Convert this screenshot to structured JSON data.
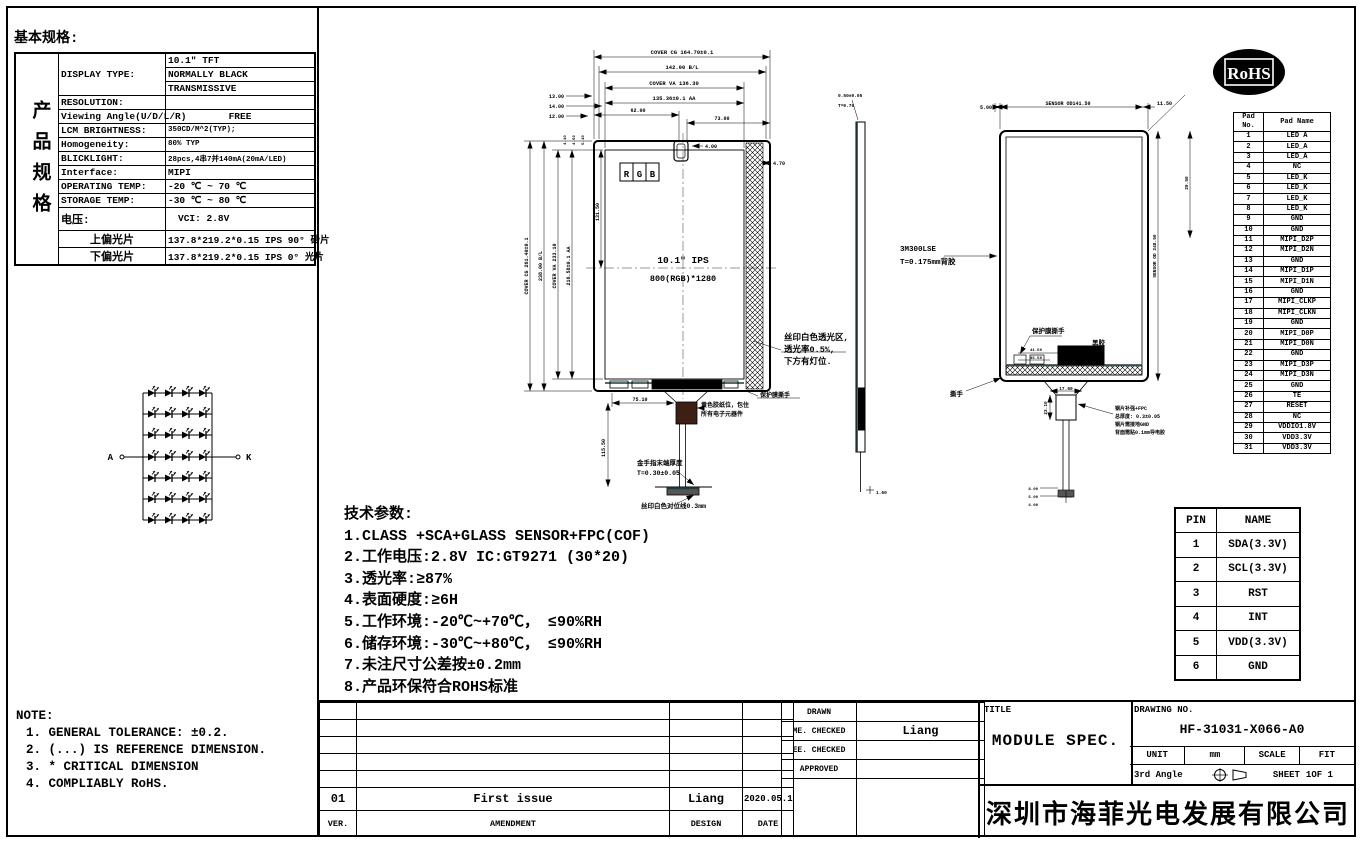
{
  "spec": {
    "heading": "基本规格:",
    "side": "产品规格",
    "rows": [
      {
        "label": "DISPLAY TYPE:",
        "value": "10.1\" TFT"
      },
      {
        "label": "",
        "value": "NORMALLY BLACK"
      },
      {
        "label": "",
        "value": "TRANSMISSIVE"
      },
      {
        "label": "RESOLUTION:",
        "value": ""
      },
      {
        "label": "Viewing Angle(U/D/L/R)",
        "value": "FREE"
      },
      {
        "label": "LCM BRIGHTNESS:",
        "value": "350CD/M^2(TYP);"
      },
      {
        "label": "Homogeneity:",
        "value": "80% TYP"
      },
      {
        "label": "BLICKLIGHT:",
        "value": "28pcs,4串7并140mA(20mA/LED)"
      },
      {
        "label": "Interface:",
        "value": "MIPI"
      },
      {
        "label": "OPERATING TEMP:",
        "value": "-20 ℃ ~ 70 ℃"
      },
      {
        "label": "STORAGE TEMP:",
        "value": "-30 ℃ ~ 80 ℃"
      },
      {
        "label": "电压:",
        "value": "VCI: 2.8V"
      },
      {
        "label": "上偏光片",
        "value": "137.8*219.2*0.15 IPS 90° 砂片"
      },
      {
        "label": "下偏光片",
        "value": "137.8*219.2*0.15 IPS 0° 光片"
      }
    ]
  },
  "led_diagram": {
    "anode_label": "A",
    "cathode_label": "K"
  },
  "tech": {
    "title": "技术参数:",
    "items": [
      "1.CLASS +SCA+GLASS SENSOR+FPC(COF)",
      "2.工作电压:2.8V  IC:GT9271 (30*20)",
      "3.透光率:≥87%",
      "4.表面硬度:≥6H",
      "5.工作环境:-20℃~+70℃， ≤90%RH",
      "6.储存环境:-30℃~+80℃， ≤90%RH",
      "7.未注尺寸公差按±0.2mm",
      "8.产品环保符合ROHS标准"
    ]
  },
  "note": {
    "title": "NOTE:",
    "items": [
      "1. GENERAL TOLERANCE: ±0.2.",
      "2. (...) IS REFERENCE DIMENSION.",
      "3. * CRITICAL DIMENSION",
      "4. COMPLIABLY RoHS."
    ]
  },
  "pad_table": {
    "headers": [
      "Pad No.",
      "Pad Name"
    ],
    "rows": [
      {
        "no": "1",
        "name": "LED A"
      },
      {
        "no": "2",
        "name": "LED_A"
      },
      {
        "no": "3",
        "name": "LED_A"
      },
      {
        "no": "4",
        "name": "NC"
      },
      {
        "no": "5",
        "name": "LED_K"
      },
      {
        "no": "6",
        "name": "LED_K"
      },
      {
        "no": "7",
        "name": "LED_K"
      },
      {
        "no": "8",
        "name": "LED_K"
      },
      {
        "no": "9",
        "name": "GND"
      },
      {
        "no": "10",
        "name": "GND"
      },
      {
        "no": "11",
        "name": "MIPI_D2P"
      },
      {
        "no": "12",
        "name": "MIPI_D2N"
      },
      {
        "no": "13",
        "name": "GND"
      },
      {
        "no": "14",
        "name": "MIPI_D1P"
      },
      {
        "no": "15",
        "name": "MIPI_D1N"
      },
      {
        "no": "16",
        "name": "GND"
      },
      {
        "no": "17",
        "name": "MIPI_CLKP"
      },
      {
        "no": "18",
        "name": "MIPI_CLKN"
      },
      {
        "no": "19",
        "name": "GND"
      },
      {
        "no": "20",
        "name": "MIPI_D0P"
      },
      {
        "no": "21",
        "name": "MIPI_D0N"
      },
      {
        "no": "22",
        "name": "GND"
      },
      {
        "no": "23",
        "name": "MIPI_D3P"
      },
      {
        "no": "24",
        "name": "MIPI_D3N"
      },
      {
        "no": "25",
        "name": "GND"
      },
      {
        "no": "26",
        "name": "TE"
      },
      {
        "no": "27",
        "name": "RESET"
      },
      {
        "no": "28",
        "name": "NC"
      },
      {
        "no": "29",
        "name": "VDDIO1.8V"
      },
      {
        "no": "30",
        "name": "VDD3.3V"
      },
      {
        "no": "31",
        "name": "VDD3.3V"
      }
    ]
  },
  "pin_table": {
    "headers": [
      "PIN",
      "NAME"
    ],
    "rows": [
      {
        "pin": "1",
        "name": "SDA(3.3V)"
      },
      {
        "pin": "2",
        "name": "SCL(3.3V)"
      },
      {
        "pin": "3",
        "name": "RST"
      },
      {
        "pin": "4",
        "name": "INT"
      },
      {
        "pin": "5",
        "name": "VDD(3.3V)"
      },
      {
        "pin": "6",
        "name": "GND"
      }
    ]
  },
  "rohs": {
    "label": "RoHS"
  },
  "revision": {
    "headers": [
      "VER.",
      "AMENDMENT",
      "DESIGN",
      "DATE"
    ],
    "entry": {
      "ver": "01",
      "amendment": "First issue",
      "design": "Liang",
      "date": "2020.05.10"
    }
  },
  "approvals": {
    "labels": [
      "DRAWN",
      "ME. CHECKED",
      "EE. CHECKED",
      "APPROVED"
    ],
    "me_checked_value": "Liang"
  },
  "title_block": {
    "title_label": "TITLE",
    "title": "MODULE SPEC.",
    "drawing_no_label": "DRAWING NO.",
    "drawing_no": "HF-31031-X066-A0",
    "unit_label": "UNIT",
    "unit": "mm",
    "scale_label": "SCALE",
    "scale": "FIT",
    "angle_label": "3rd Angle",
    "sheet_label": "SHEET",
    "sheet": "1OF 1",
    "company": "深圳市海菲光电发展有限公司"
  },
  "drawing": {
    "front": {
      "title_line1": "10.1\" IPS",
      "title_line2": "800(RGB)*1280",
      "rgb": [
        "R",
        "G",
        "B"
      ],
      "top_dims": [
        "COVER CG 164.70±0.1",
        "142.00 B/L",
        "COVER VA 136.30",
        "135.36±0.1 AA"
      ],
      "left_small_dims": [
        "13.00",
        "14.00",
        "12.00"
      ],
      "d62": "62.00",
      "d73": "73.00",
      "d4": "4.00",
      "d47": "4.70",
      "d751": "75.10",
      "v115": "115.50",
      "v131": "131.50",
      "left_vert_dims": [
        "COVER CG 261.40±0.1",
        "238.00 B/L",
        "COVER VA 233.10",
        "216.58±0.1 AA"
      ],
      "corner_dims": [
        "4.10",
        "4.50",
        "5.10"
      ],
      "callout_window": [
        "丝印白色透光区,",
        "透光率0.5%,",
        "下方有灯位."
      ],
      "callout_peel": "保护膜撕手",
      "callout_tape": [
        "黄色胶纸位，包住",
        "所有电子元器件"
      ],
      "callout_finger": [
        "金手指末端厚度",
        "T=0.30±0.05"
      ],
      "callout_align": "丝印白色对位线0.3mm"
    },
    "side": {
      "label_line1": "3M300LSE",
      "label_line2": "T=0.175mm背胶",
      "foot_dim": "1.60"
    },
    "back": {
      "dim_left": "5.00",
      "dim_center": "SENSOR OD141.50",
      "dim_right": "11.50",
      "right_vert_dim": "SENSOR OD 248.50",
      "corner_dim": "29.50",
      "callout_peel": "保护膜撕手",
      "callout_glue": "黑胶",
      "callout_tear": "撕手",
      "tab_dims": [
        "41.50",
        "45.50"
      ],
      "fpc_dim": "17.60",
      "fpc_vert_dim": "23.10",
      "fpc_note": [
        "钢片补强+FPC",
        "总厚度: 0.3±0.05",
        "钢片需接地GND",
        "背面需贴0.1mm导电胶"
      ],
      "tail_dims": [
        "8.00",
        "5.00",
        "4.00"
      ],
      "edge_dims": [
        "0.50±0.05",
        "T=0.70"
      ]
    }
  }
}
